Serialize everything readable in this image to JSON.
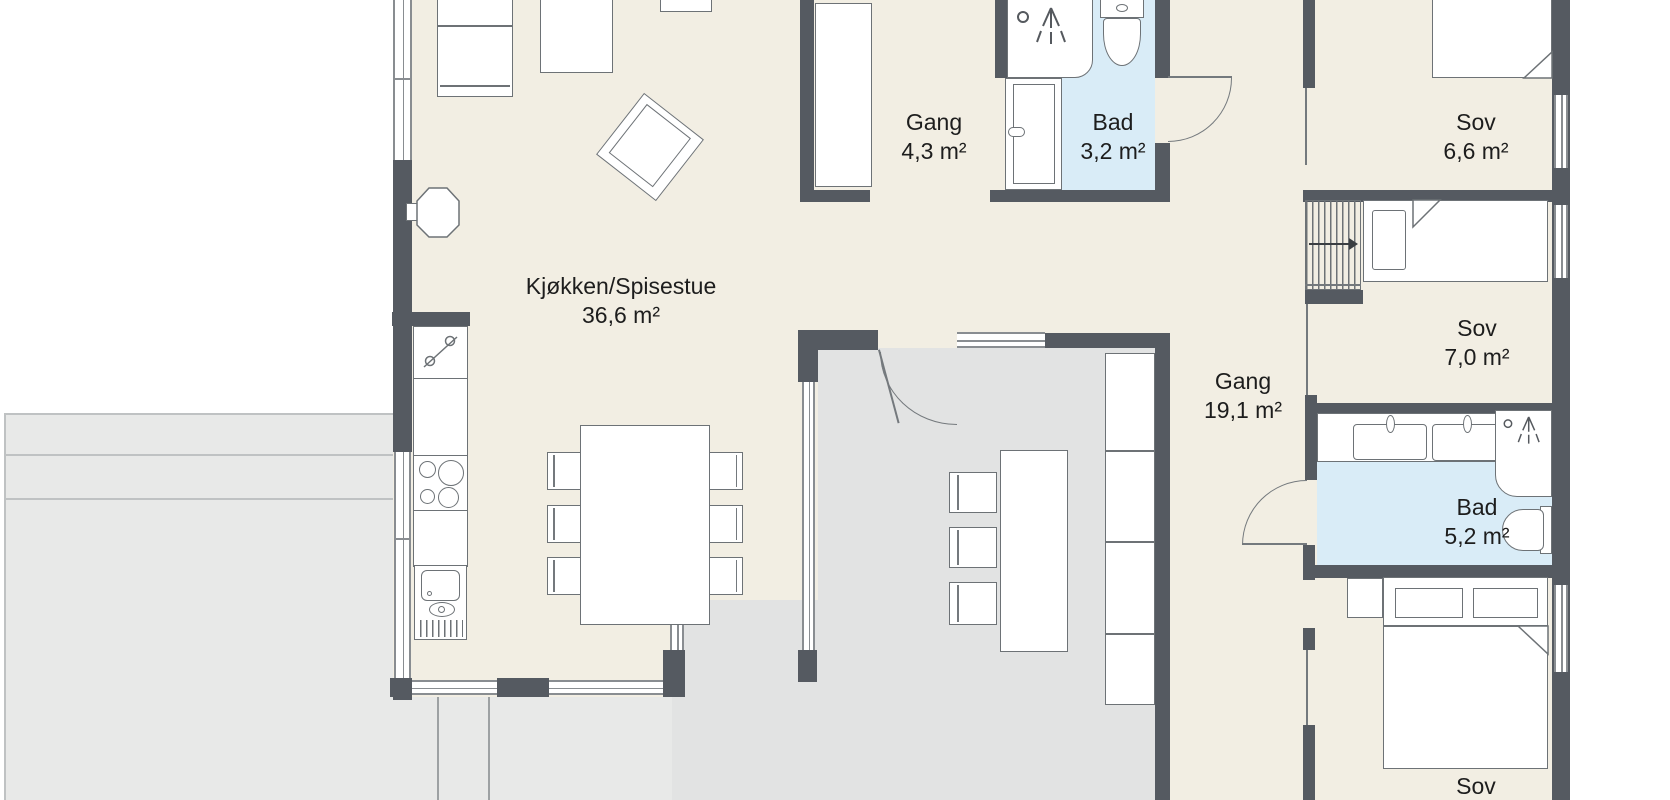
{
  "plan_type": "floor-plan",
  "language": "no",
  "rooms": [
    {
      "id": "kitchen-dining",
      "name": "Kjøkken/Spisestue",
      "area": "36,6 m²"
    },
    {
      "id": "hall-top",
      "name": "Gang",
      "area": "4,3 m²"
    },
    {
      "id": "bath-small",
      "name": "Bad",
      "area": "3,2 m²"
    },
    {
      "id": "bedroom-1",
      "name": "Sov",
      "area": "6,6 m²"
    },
    {
      "id": "bedroom-2",
      "name": "Sov",
      "area": "7,0 m²"
    },
    {
      "id": "hall-main",
      "name": "Gang",
      "area": "19,1 m²"
    },
    {
      "id": "bath-main",
      "name": "Bad",
      "area": "5,2 m²"
    },
    {
      "id": "bedroom-3",
      "name": "Sov",
      "area": ""
    }
  ],
  "colors": {
    "wall": "#555a61",
    "floor": "#f2eee3",
    "annex": "#e2e3e3",
    "bath": "#d9ecf7",
    "terrace": "#e8e9e8",
    "outline": "#6d7276",
    "text": "#1d1d1d"
  }
}
